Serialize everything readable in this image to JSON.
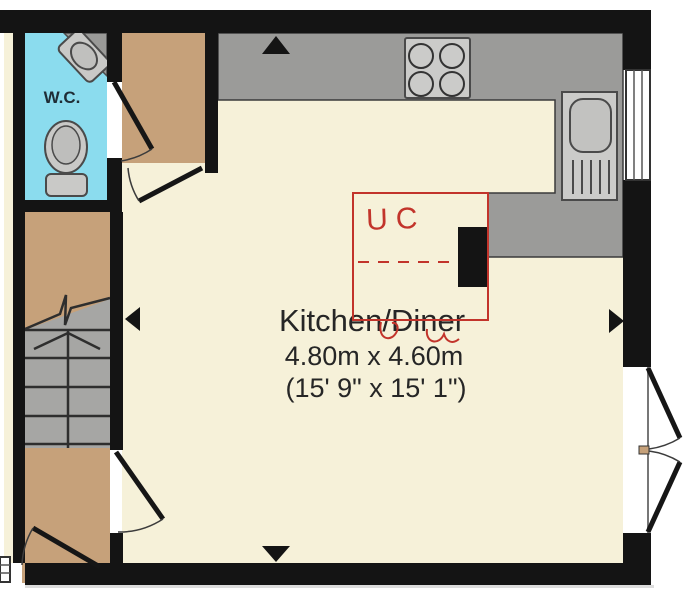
{
  "title": "Kitchen/Diner floor plan",
  "rooms": {
    "wc": {
      "label": "W.C."
    },
    "kitchen": {
      "label": "Kitchen/Diner",
      "size_metric": "4.80m x 4.60m",
      "size_imperial": "(15' 9\" x 15' 1\")"
    }
  },
  "annotations": {
    "handwritten": "UC"
  },
  "colors": {
    "background": "#FFFFFF",
    "wall": "#141414",
    "kitchen_floor": "#F6F1D9",
    "hall_floor": "#C6A17A",
    "wc_floor": "#8BDCEE",
    "counter": "#9B9B99",
    "appliance_light": "#CBCBC9",
    "stairs": "#A6A6A4",
    "fixture": "#C9C9C7",
    "annotation_red": "#C2342B"
  }
}
